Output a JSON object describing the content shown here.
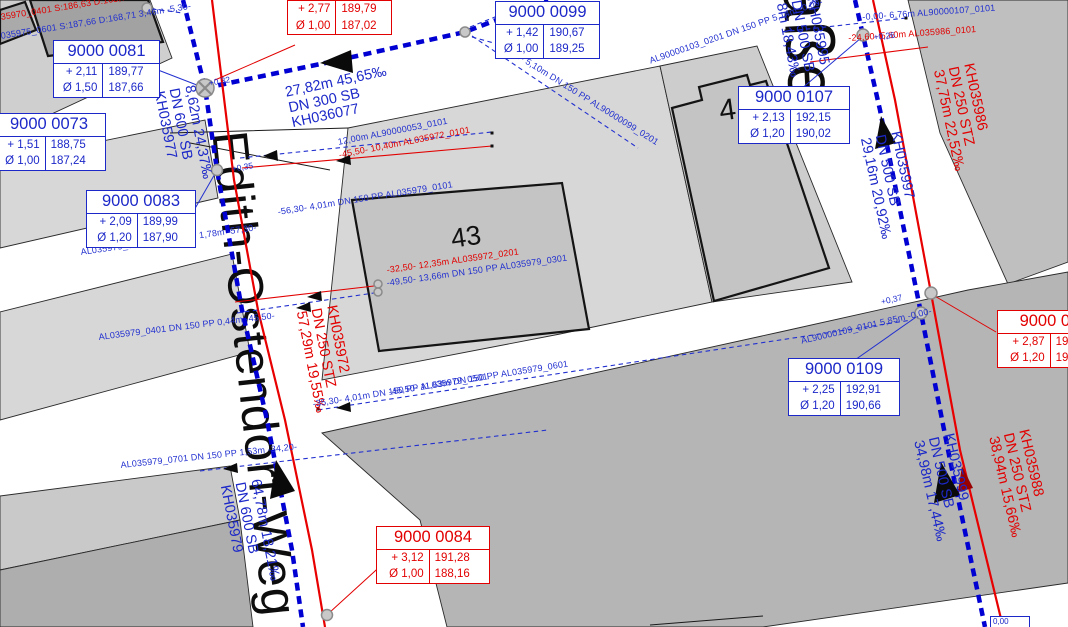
{
  "map": {
    "streets": {
      "main": "Edith-Ostendorf-Weg",
      "main_top_fragment": "e",
      "right": "aße"
    },
    "buildings": {
      "center": "43",
      "right": "4"
    },
    "boxes": [
      {
        "id": "9000 0081",
        "color": "blue",
        "rows": [
          [
            "+ 2,11",
            "189,77"
          ],
          [
            "Ø 1,50",
            "187,66"
          ]
        ]
      },
      {
        "id": "9000 0073",
        "color": "blue",
        "rows": [
          [
            "+ 1,51",
            "188,75"
          ],
          [
            "Ø 1,00",
            "187,24"
          ]
        ]
      },
      {
        "id": "9000 0083",
        "color": "blue",
        "rows": [
          [
            "+ 2,09",
            "189,99"
          ],
          [
            "Ø 1,20",
            "187,90"
          ]
        ]
      },
      {
        "id": "9000 0099",
        "color": "blue",
        "rows": [
          [
            "+ 1,42",
            "190,67"
          ],
          [
            "Ø 1,00",
            "189,25"
          ]
        ]
      },
      {
        "id": "9000 0107",
        "color": "blue",
        "rows": [
          [
            "+ 2,13",
            "192,15"
          ],
          [
            "Ø 1,20",
            "190,02"
          ]
        ]
      },
      {
        "id": "9000 0109",
        "color": "blue",
        "rows": [
          [
            "+ 2,25",
            "192,91"
          ],
          [
            "Ø 1,20",
            "190,66"
          ]
        ]
      },
      {
        "id": "9000 010",
        "color": "red",
        "rows": [
          [
            "+ 2,87",
            "192,9"
          ],
          [
            "Ø 1,20",
            "190,6"
          ]
        ]
      },
      {
        "id": "9000 0084",
        "color": "red",
        "rows": [
          [
            "+ 3,12",
            "191,28"
          ],
          [
            "Ø 1,00",
            "188,16"
          ]
        ]
      },
      {
        "id": "",
        "color": "red",
        "rows": [
          [
            "+ 2,77",
            "189,79"
          ],
          [
            "Ø 1,00",
            "187,02"
          ]
        ]
      },
      {
        "id": "0,00",
        "color": "blue",
        "rows": []
      }
    ],
    "pipe_labels": [
      {
        "color": "blue",
        "lines": [
          "27,82m 45,65‰",
          "DN 300 SB",
          "KH036077"
        ]
      },
      {
        "color": "blue",
        "lines": [
          "8,62m 24,37‰",
          "DN 600 SB",
          "KH035977"
        ]
      },
      {
        "color": "blue",
        "lines": [
          "64,78m 18,21‰",
          "DN 600 SB",
          "KH035979"
        ]
      },
      {
        "color": "blue",
        "lines": [
          "29,16m 20,92‰",
          "DN 500 SB",
          "KH035997"
        ]
      },
      {
        "color": "blue",
        "lines": [
          "8m 18,43‰",
          "DN 500 SB",
          "KH035995"
        ]
      },
      {
        "color": "blue",
        "lines": [
          "34,98m 17,44‰",
          "DN 500 SB",
          "KH035999"
        ]
      },
      {
        "color": "red",
        "lines": [
          "57,29m 19,55‰",
          "DN 250 STZ",
          "KH035972"
        ]
      },
      {
        "color": "red",
        "lines": [
          "37,75m 22,52‰",
          "DN 250 STZ",
          "KH035986"
        ]
      },
      {
        "color": "red",
        "lines": [
          "38,94m 15,66‰",
          "DN 250 STZ",
          "KH035988"
        ]
      }
    ],
    "annotations": [
      {
        "color": "blue",
        "text": "12,00m AL90000053_0101"
      },
      {
        "color": "red",
        "text": "-45,50- 10,40m AL035972_0101"
      },
      {
        "color": "blue",
        "text": "-56,30- 4,01m DN 150 PP AL035979_0101"
      },
      {
        "color": "blue",
        "text": "AL035979_0201 DN 150 PP 1,78m -57,30-"
      },
      {
        "color": "blue",
        "text": "AL035979_0401 DN 150 PP 0,44m -45,50-"
      },
      {
        "color": "blue",
        "text": "-35,30- 4,01m DN 150 PP AL035979_0501"
      },
      {
        "color": "blue",
        "text": "-45,50- 11,63m DN 150 PP AL035979_0601"
      },
      {
        "color": "blue",
        "text": "AL035979_0701 DN 150 PP 1,53m -34,20-"
      },
      {
        "color": "blue",
        "text": "-0,00- 5,10m DN 150 PP AL90000099_0201"
      },
      {
        "color": "blue",
        "text": "AL90000103_0201 DN 150 PP 5,14m -0,00-"
      },
      {
        "color": "blue",
        "text": "-0,00- 6,76m AL90000107_0101"
      },
      {
        "color": "red",
        "text": "-24,60- 5,60m AL035986_0101"
      },
      {
        "color": "blue",
        "text": "AL90000109_0101 5,85m -0,00-"
      },
      {
        "color": "red",
        "text": "-32,50- 12,35m AL035972_0201"
      },
      {
        "color": "blue",
        "text": "-49,50- 13,66m DN 150 PP AL035979_0301"
      },
      {
        "color": "red",
        "text": "35970_0401 S:186,63 D:168,73 -6,30-"
      },
      {
        "color": "blue",
        "text": "035975_0601 S:187,66 D:168,71 3,46m -5,30-"
      }
    ],
    "deltas": [
      "+0,32",
      "+0,35",
      "+0,26",
      "+0,37"
    ]
  }
}
